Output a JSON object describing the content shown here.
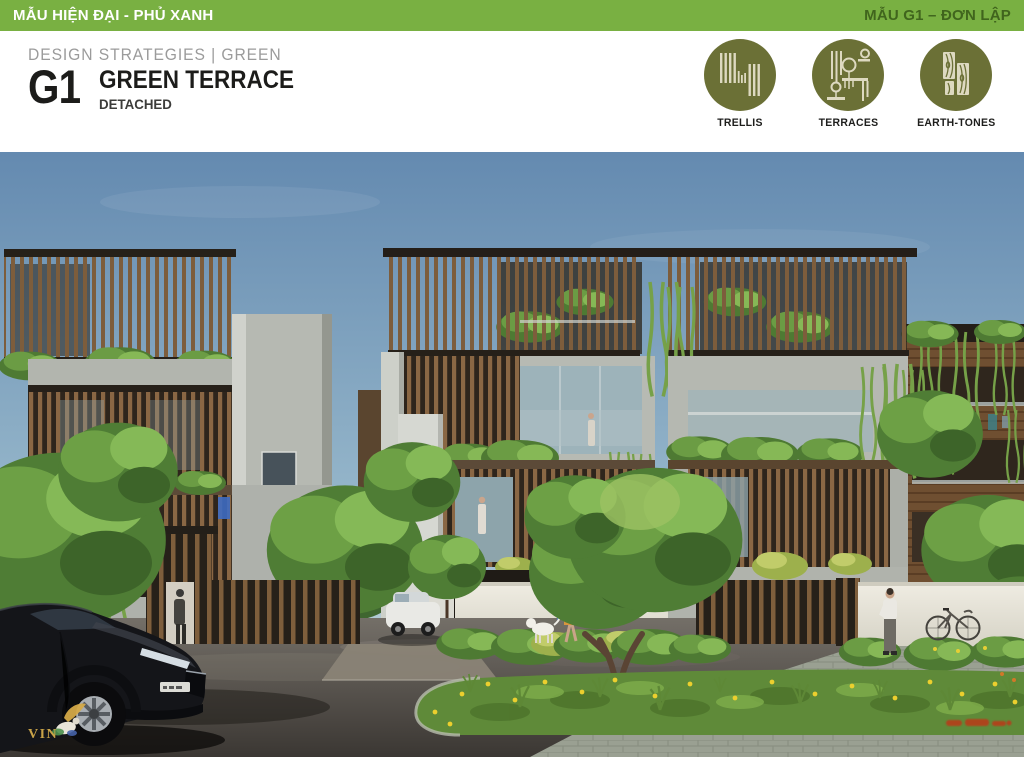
{
  "top_bar": {
    "left_title": "MẪU HIỆN ĐẠI - PHỦ XANH",
    "right_title": "MẪU G1 – ĐƠN LẬP"
  },
  "header": {
    "eyebrow": "DESIGN STRATEGIES | GREEN",
    "code": "G1",
    "title": "GREEN TERRACE",
    "subtitle": "DETACHED"
  },
  "strategies": [
    {
      "label": "TRELLIS",
      "icon": "trellis-icon"
    },
    {
      "label": "TERRACES",
      "icon": "terraces-icon"
    },
    {
      "label": "EARTH-TONES",
      "icon": "earth-tones-icon"
    }
  ],
  "illustration": {
    "logo_text": "VIN"
  },
  "colors": {
    "bar_green": "#79b042",
    "bar_text_left": "#ffffff",
    "bar_text_right": "#40651d",
    "olive_icon_bg": "#6b7036",
    "icon_glyph": "#ddd9c0",
    "heading_black": "#1c1c1a",
    "eyebrow_gray": "#9b9b9b"
  }
}
